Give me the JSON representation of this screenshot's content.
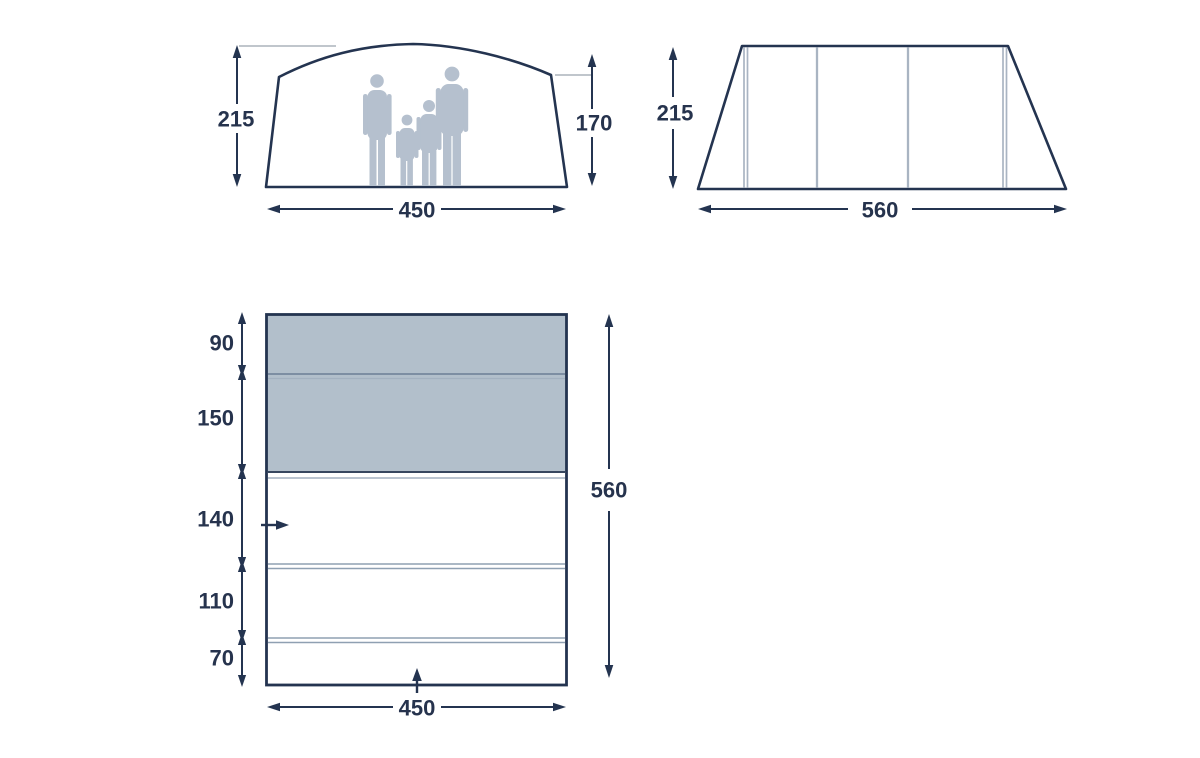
{
  "diagram": {
    "type": "tent-dimension-drawing",
    "colors": {
      "outline": "#243450",
      "text": "#26334d",
      "shaded_fill": "#b2bfcb",
      "pole_line": "#a9b4c2",
      "silhouette": "#b5c0ce",
      "divider_line": "#8fa0b2",
      "reference_line": "#9aa3ad",
      "background": "#ffffff"
    },
    "front_view": {
      "height_left": "215",
      "height_right": "170",
      "width": "450"
    },
    "side_view": {
      "height": "215",
      "length": "560"
    },
    "floor_plan": {
      "sections": [
        "90",
        "150",
        "140",
        "110",
        "70"
      ],
      "total_length": "560",
      "width": "450"
    }
  }
}
